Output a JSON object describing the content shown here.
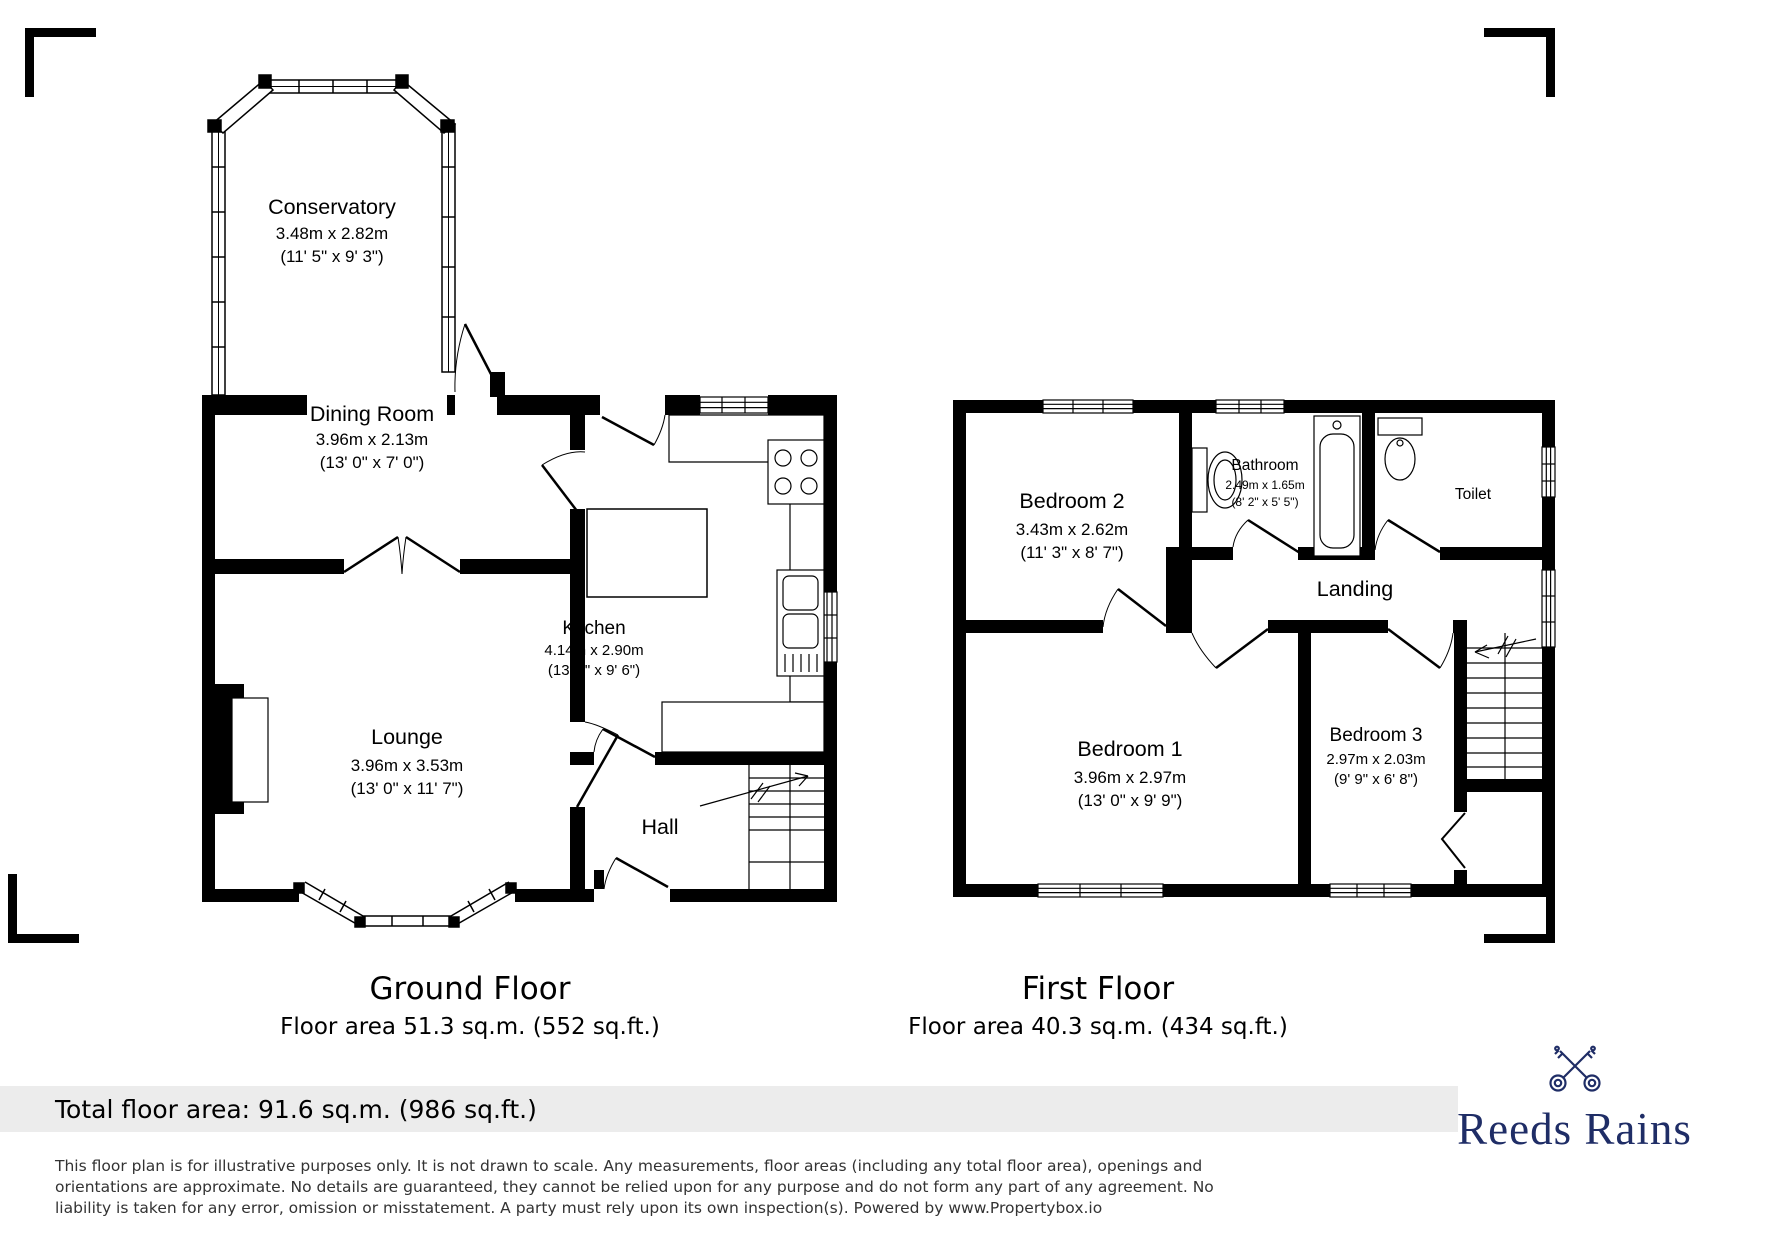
{
  "ground_floor": {
    "title": "Ground Floor",
    "area": "Floor area 51.3 sq.m. (552 sq.ft.)",
    "rooms": {
      "conservatory": {
        "name": "Conservatory",
        "metric": "3.48m x 2.82m",
        "imperial": "(11' 5\" x 9' 3\")"
      },
      "dining_room": {
        "name": "Dining Room",
        "metric": "3.96m x 2.13m",
        "imperial": "(13' 0\" x 7' 0\")"
      },
      "kitchen": {
        "name": "Kitchen",
        "metric": "4.14m x 2.90m",
        "imperial": "(13' 7\" x 9' 6\")"
      },
      "lounge": {
        "name": "Lounge",
        "metric": "3.96m x 3.53m",
        "imperial": "(13' 0\" x 11' 7\")"
      },
      "hall": {
        "name": "Hall"
      }
    }
  },
  "first_floor": {
    "title": "First Floor",
    "area": "Floor area 40.3 sq.m. (434 sq.ft.)",
    "rooms": {
      "bedroom_2": {
        "name": "Bedroom 2",
        "metric": "3.43m x 2.62m",
        "imperial": "(11' 3\" x 8' 7\")"
      },
      "bathroom": {
        "name": "Bathroom",
        "metric": "2.49m x 1.65m",
        "imperial": "(8' 2\" x 5' 5\")"
      },
      "toilet": {
        "name": "Toilet"
      },
      "landing": {
        "name": "Landing"
      },
      "bedroom_1": {
        "name": "Bedroom 1",
        "metric": "3.96m x 2.97m",
        "imperial": "(13' 0\" x 9' 9\")"
      },
      "bedroom_3": {
        "name": "Bedroom 3",
        "metric": "2.97m x 2.03m",
        "imperial": "(9' 9\" x 6' 8\")"
      }
    }
  },
  "footer": {
    "total_area": "Total floor area: 91.6 sq.m. (986 sq.ft.)",
    "disclaimer": "This floor plan is for illustrative purposes only. It is not drawn to scale. Any measurements, floor areas (including any total floor area), openings and orientations are approximate. No details are guaranteed, they cannot be relied upon for any purpose and do not form any part of any agreement. No liability is taken for any error, omission or misstatement. A party must rely upon its own inspection(s). Powered by www.Propertybox.io"
  },
  "brand": {
    "name": "Reeds Rains",
    "color": "#1f2d66"
  }
}
